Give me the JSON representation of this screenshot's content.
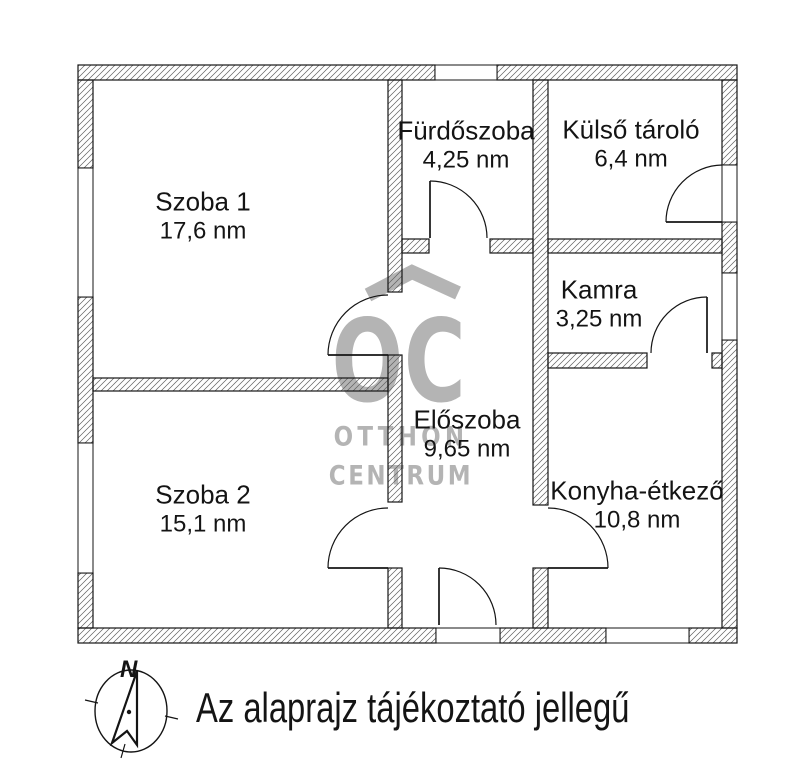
{
  "floorplan": {
    "rooms": [
      {
        "id": "szoba-1",
        "name": "Szoba 1",
        "area": "17,6 nm"
      },
      {
        "id": "szoba-2",
        "name": "Szoba 2",
        "area": "15,1 nm"
      },
      {
        "id": "furdoszoba",
        "name": "Fürdőszoba",
        "area": "4,25 nm"
      },
      {
        "id": "kulso-tarolo",
        "name": "Külső tároló",
        "area": "6,4 nm"
      },
      {
        "id": "kamra",
        "name": "Kamra",
        "area": "3,25 nm"
      },
      {
        "id": "eloszoba",
        "name": "Előszoba",
        "area": "9,65 nm"
      },
      {
        "id": "konyha-etkezo",
        "name": "Konyha-étkező",
        "area": "10,8 nm"
      }
    ],
    "compass": {
      "north_label": "N"
    },
    "caption": "Az alaprajz tájékoztató jellegű",
    "watermark": {
      "logo": "OC",
      "line1": "OTTHON",
      "line2": "CENTRUM"
    },
    "colors": {
      "line": "#141414",
      "watermark": "#b4b4b4",
      "background": "#ffffff"
    }
  }
}
